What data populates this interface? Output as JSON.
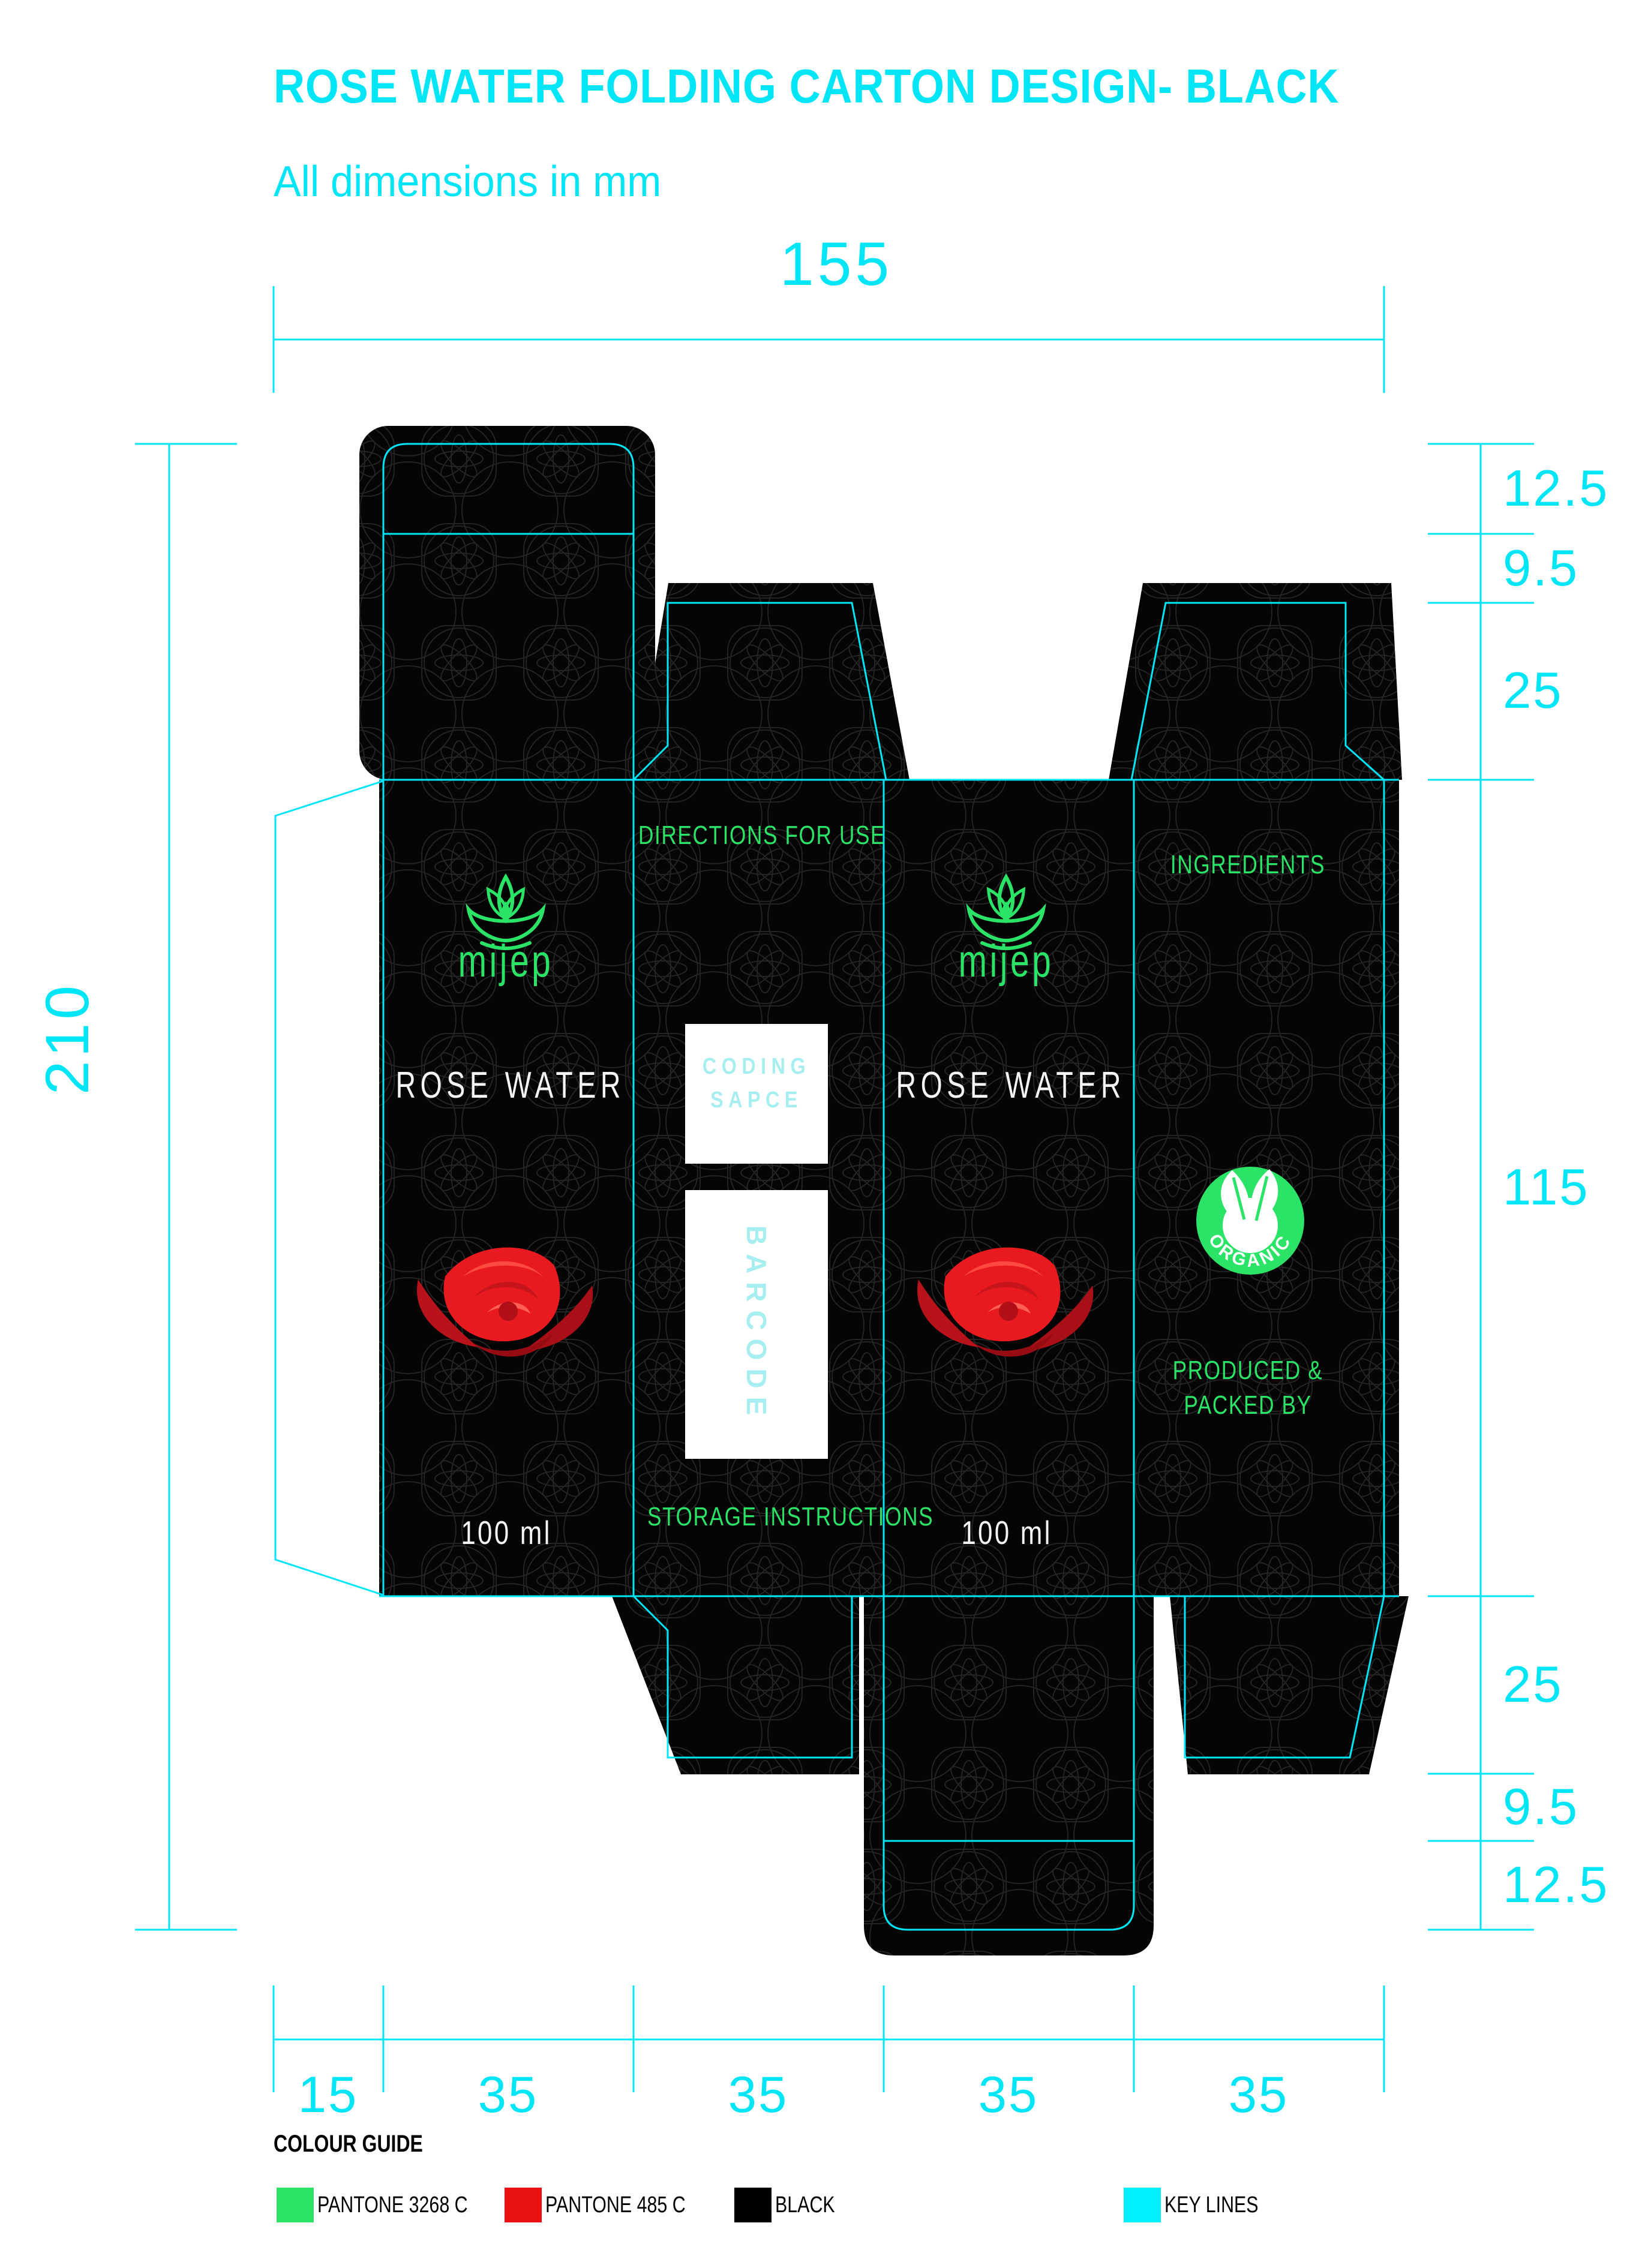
{
  "header": {
    "title": "ROSE WATER FOLDING CARTON DESIGN- BLACK",
    "subtitle": "All dimensions in mm"
  },
  "dimensions": {
    "total_width": "155",
    "total_height": "210",
    "right": [
      "12.5",
      "9.5",
      "25",
      "115",
      "25",
      "9.5",
      "12.5"
    ],
    "bottom": [
      "15",
      "35",
      "35",
      "35",
      "35"
    ]
  },
  "carton": {
    "front_panel": {
      "brand": "mijep",
      "product": "ROSE WATER",
      "volume": "100 ml"
    },
    "back_panel": {
      "brand": "mijep",
      "product": "ROSE WATER",
      "volume": "100 ml"
    },
    "usage_panel": {
      "heading": "DIRECTIONS FOR USE",
      "coding_line1": "CODING",
      "coding_line2": "SAPCE",
      "barcode_label": "BARCODE",
      "footer": "STORAGE INSTRUCTIONS"
    },
    "info_panel": {
      "heading": "INGREDIENTS",
      "badge": "ORGANIC",
      "produced_line1": "PRODUCED &",
      "produced_line2": "PACKED BY"
    }
  },
  "colour_guide": {
    "title": "COLOUR GUIDE",
    "swatches": [
      {
        "label": "PANTONE 3268 C",
        "color": "#2BE467"
      },
      {
        "label": "PANTONE 485 C",
        "color": "#ED1212"
      },
      {
        "label": "BLACK",
        "color": "#000000"
      },
      {
        "label": "KEY LINES",
        "color": "#00F0FF"
      }
    ]
  },
  "colors": {
    "keyline": "#00E6F7",
    "brand_green": "#2BE467",
    "rose_red": "#E8191F",
    "panel_black": "#050505"
  }
}
